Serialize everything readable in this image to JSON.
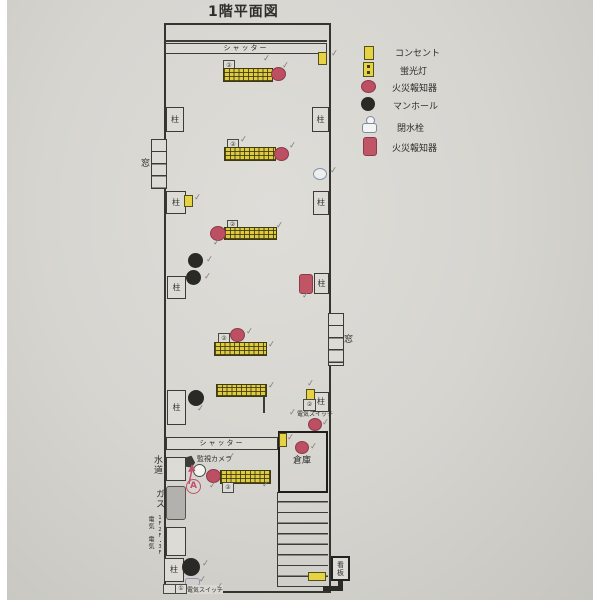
{
  "title": "1階平面図",
  "legend": {
    "items": [
      {
        "name": "outlet",
        "label": "コンセント"
      },
      {
        "name": "fluorescent-light",
        "label": "蛍光灯"
      },
      {
        "name": "fire-alarm-round",
        "label": "火災報知器"
      },
      {
        "name": "manhole",
        "label": "マンホール"
      },
      {
        "name": "water-stop-valve",
        "label": "閉水栓"
      },
      {
        "name": "fire-alarm-rect",
        "label": "火災報知器"
      }
    ]
  },
  "plan": {
    "shutter": "シャッター",
    "pillar": "柱",
    "window": "窓",
    "storage": "倉庫",
    "camera": "監視カメラ",
    "electric_switch": "電気スイッチ",
    "water": "水道",
    "gas": "ガス",
    "electric": "電気",
    "floors": "1F2F・3F",
    "signboard": "看板",
    "annotation_a": "A",
    "check": "✓",
    "light_tag": "②",
    "switch_tag": "①"
  },
  "colors": {
    "paper": "#d6d5d0",
    "outlet_yellow": "#e7d243",
    "fire_alarm_red": "#bd4f62",
    "manhole_black": "#292926",
    "valve_blue": "#8093b6",
    "switch_blue": "#8f94c8",
    "pencil_check": "#83837c",
    "annotation_red": "#c34f6b",
    "wall": "#35352f"
  }
}
